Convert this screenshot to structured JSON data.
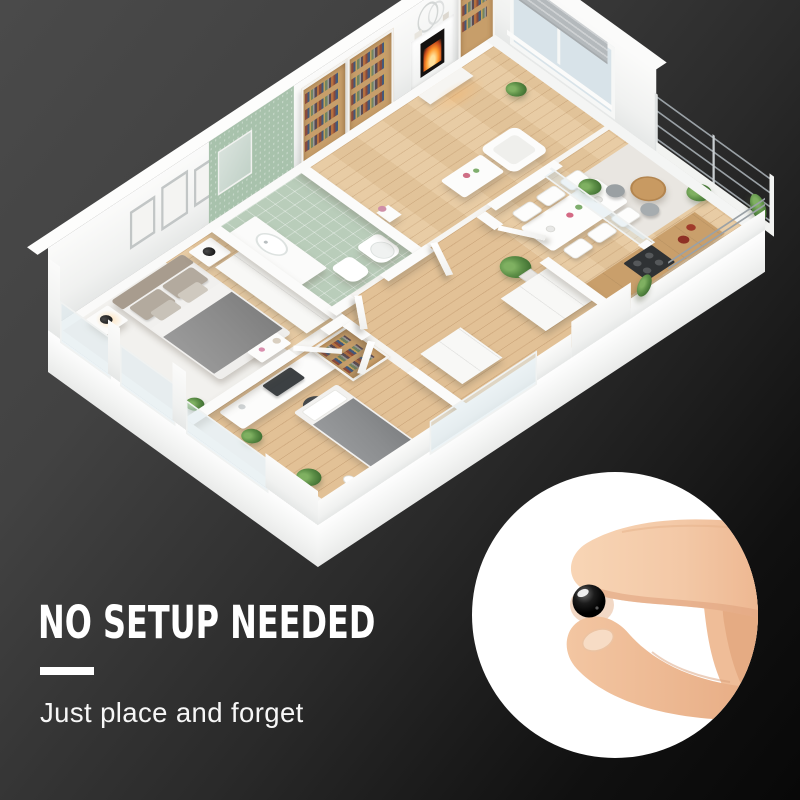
{
  "hero": {
    "headline": "NO SETUP NEEDED",
    "subheadline": "Just place and forget"
  },
  "palette": {
    "background_top_left": "#4a4a4a",
    "background_bottom_right": "#080808",
    "text": "#ffffff",
    "wall_white": "#f5f4f2",
    "wood_floor": "#e7c99f",
    "bathroom_green_wall": "#a8c2ac",
    "bathroom_green_floor": "#b9cdba",
    "device_ball": "#000000",
    "product_circle": "#ffffff",
    "skin": "#f3c8a6",
    "fire": "#ff9a2e"
  },
  "scene": {
    "floorplan_alt": "3D isometric apartment floor plan with living room, fireplace and bookshelves, dining room, kitchen counter, balcony, green bathroom, master bedroom, office bedroom and hallway",
    "product_alt": "Fingers holding a tiny black ball device inside a white circle",
    "rooms": [
      "master-bedroom",
      "bathroom",
      "living-room",
      "dining-room",
      "kitchen",
      "balcony",
      "hallway",
      "office-bedroom"
    ]
  }
}
